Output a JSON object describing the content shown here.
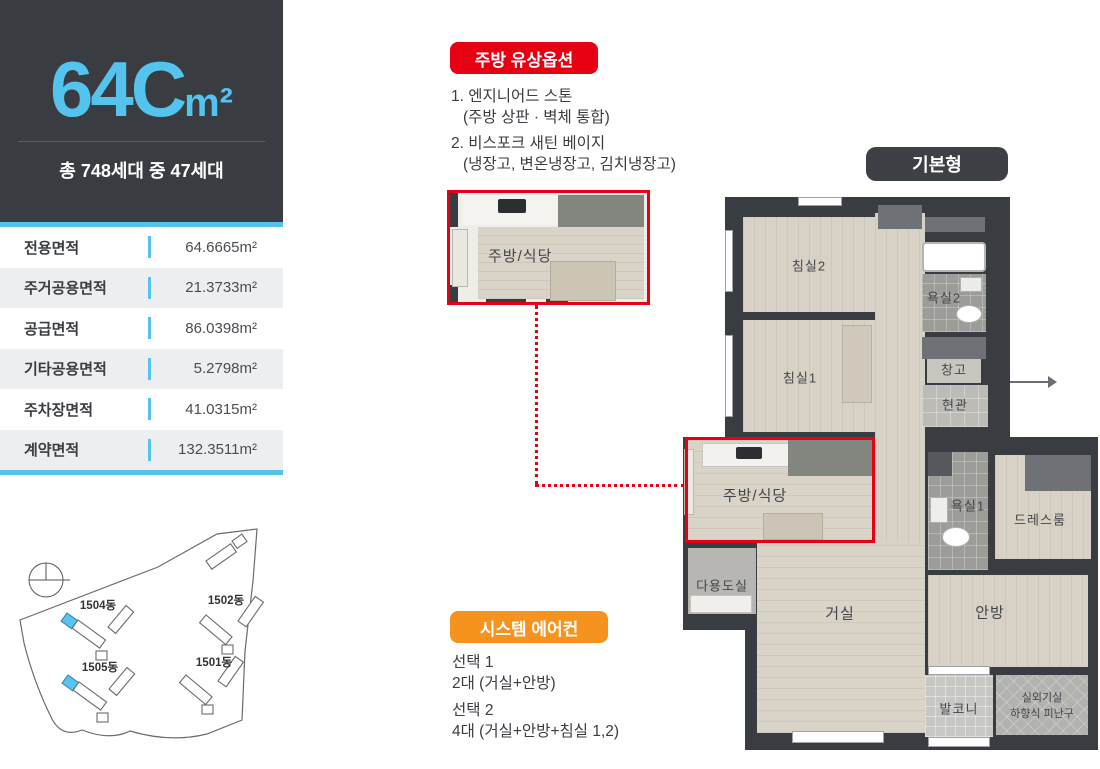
{
  "header": {
    "model": "64C",
    "unit_suffix": "m²",
    "subtitle": "총 748세대 중 47세대"
  },
  "area_table": {
    "rows": [
      {
        "label": "전용면적",
        "value": "64.6665m²"
      },
      {
        "label": "주거공용면적",
        "value": "21.3733m²"
      },
      {
        "label": "공급면적",
        "value": "86.0398m²"
      },
      {
        "label": "기타공용면적",
        "value": "5.2798m²"
      },
      {
        "label": "주차장면적",
        "value": "41.0315m²"
      },
      {
        "label": "계약면적",
        "value": "132.3511m²"
      }
    ]
  },
  "site_plan": {
    "buildings": [
      {
        "label": "1504동",
        "highlighted": true
      },
      {
        "label": "1502동",
        "highlighted": false
      },
      {
        "label": "1505동",
        "highlighted": true
      },
      {
        "label": "1501동",
        "highlighted": false
      }
    ],
    "highlight_color": "#56c6f0"
  },
  "kitchen_option": {
    "badge": "주방 유상옵션",
    "items": [
      {
        "title": "1. 엔지니어드 스톤",
        "detail": "(주방 상판 · 벽체 통합)"
      },
      {
        "title": "2. 비스포크 새틴 베이지",
        "detail": "(냉장고, 변온냉장고, 김치냉장고)"
      }
    ]
  },
  "kitchen_detail": {
    "label": "주방/식당"
  },
  "aircon_option": {
    "badge": "시스템 에어컨",
    "options": [
      {
        "title": "선택 1",
        "detail": "2대 (거실+안방)"
      },
      {
        "title": "선택 2",
        "detail": "4대 (거실+안방+침실 1,2)"
      }
    ]
  },
  "floor_plan": {
    "badge": "기본형",
    "rooms": {
      "bedroom2": "침실2",
      "bathroom2": "욕실2",
      "bedroom1": "침실1",
      "storage": "창고",
      "entrance": "현관",
      "kitchen": "주방/식당",
      "bathroom1": "욕실1",
      "dressroom": "드레스룸",
      "utility": "다용도실",
      "living": "거실",
      "master": "안방",
      "balcony": "발코니",
      "outdoor_unit": "실외기실",
      "escape_hatch": "하향식 피난구"
    }
  },
  "colors": {
    "accent_blue": "#54c3ee",
    "badge_red": "#e60012",
    "badge_orange": "#f6921e",
    "dark": "#393c41"
  }
}
